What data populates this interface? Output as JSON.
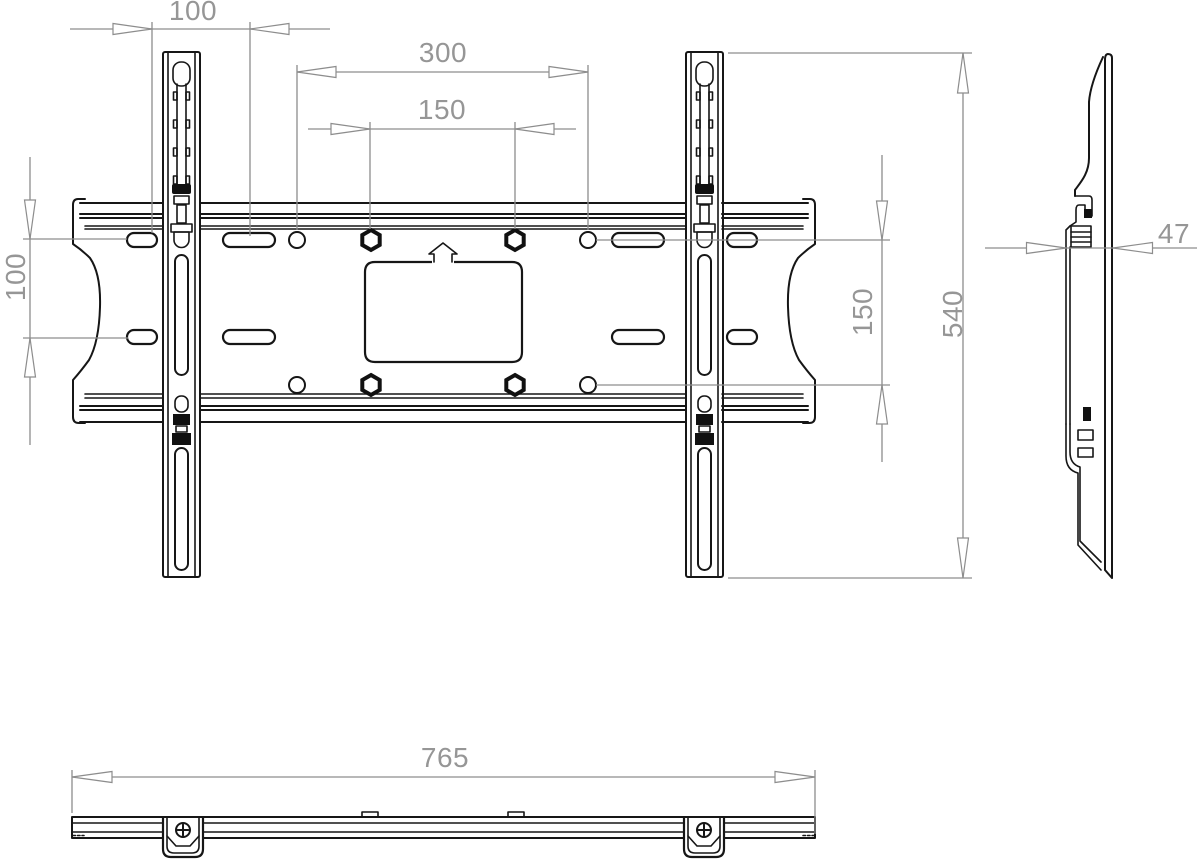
{
  "drawing": {
    "type": "technical-drawing",
    "subject": "tv-wall-mount-bracket",
    "views": {
      "front": "front-view",
      "side": "side-view",
      "bottom": "bottom-view"
    },
    "colors": {
      "background": "#ffffff",
      "object_line": "#161616",
      "dimension_line": "#8d8d8d",
      "dimension_text": "#969696"
    }
  },
  "dimensions": {
    "rail_spacing_top": "100",
    "hole_pattern_width_outer": "300",
    "hole_pattern_width_inner": "150",
    "hole_row_spacing_left": "100",
    "hole_pattern_height": "150",
    "overall_height": "540",
    "mount_depth": "47",
    "overall_width": "765"
  }
}
